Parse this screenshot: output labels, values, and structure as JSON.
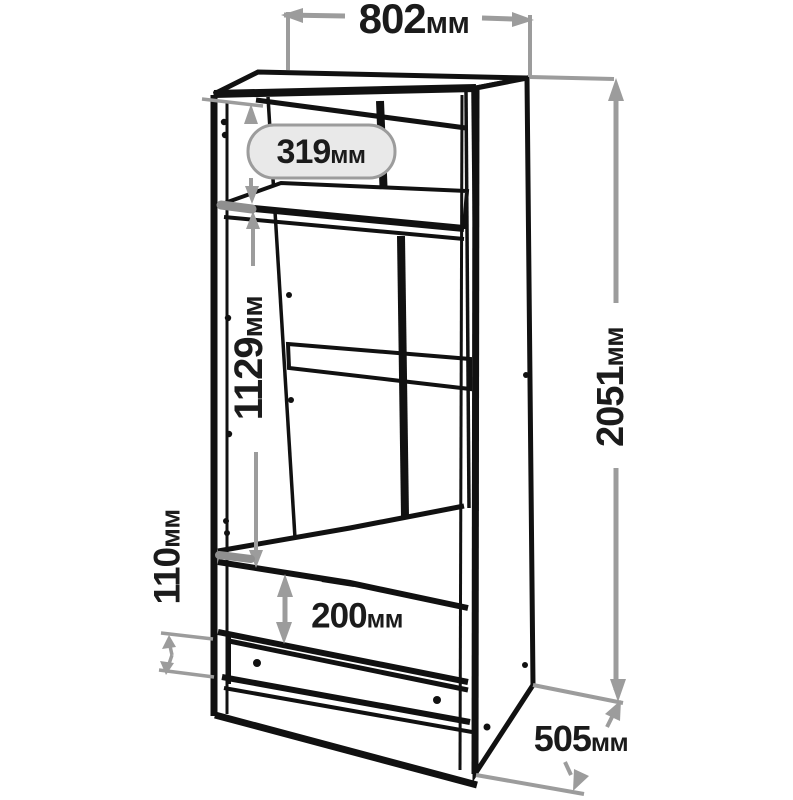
{
  "diagram": {
    "type": "furniture-dimension-drawing",
    "subject": "two-door wardrobe with drawer",
    "unit": "мм"
  },
  "dimensions": {
    "top_width": {
      "value": "802",
      "unit": "мм"
    },
    "upper_shelf_height": {
      "value": "319",
      "unit": "мм"
    },
    "hanging_area_height": {
      "value": "1129",
      "unit": "мм"
    },
    "plinth_height": {
      "value": "110",
      "unit": "мм"
    },
    "drawer_front_height": {
      "value": "200",
      "unit": "мм"
    },
    "total_height": {
      "value": "2051",
      "unit": "мм"
    },
    "depth": {
      "value": "505",
      "unit": "мм"
    }
  },
  "colors": {
    "line_black": "#111111",
    "dimension_gray": "#9c9c9c",
    "pill_fill": "#e9e9e9",
    "background": "#ffffff",
    "text_dark": "#1b1b1b"
  }
}
